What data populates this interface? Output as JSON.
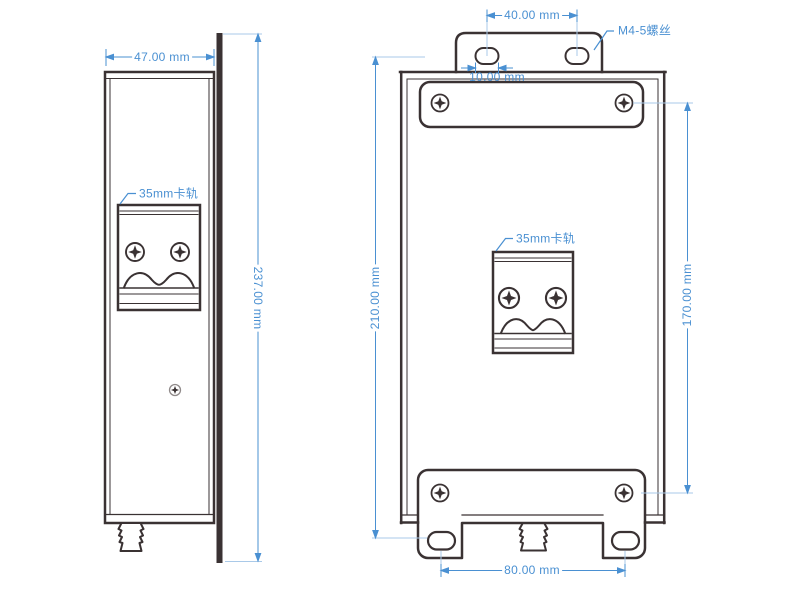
{
  "colors": {
    "line_dark": "#3a3233",
    "dimension_blue": "#4a90d2",
    "extension_blue": "#a9c9e8"
  },
  "side_view": {
    "width_dim": "47.00 mm",
    "height_dim": "237.00 mm",
    "din_rail_label": "35mm卡轨"
  },
  "front_view": {
    "top_slot_spacing_dim": "40.00 mm",
    "slot_width_dim": "10.00 mm",
    "screw_label": "M4-5螺丝",
    "din_rail_label": "35mm卡轨",
    "left_height_dim": "210.00 mm",
    "right_height_dim": "170.00 mm",
    "bottom_slot_spacing_dim": "80.00 mm"
  }
}
